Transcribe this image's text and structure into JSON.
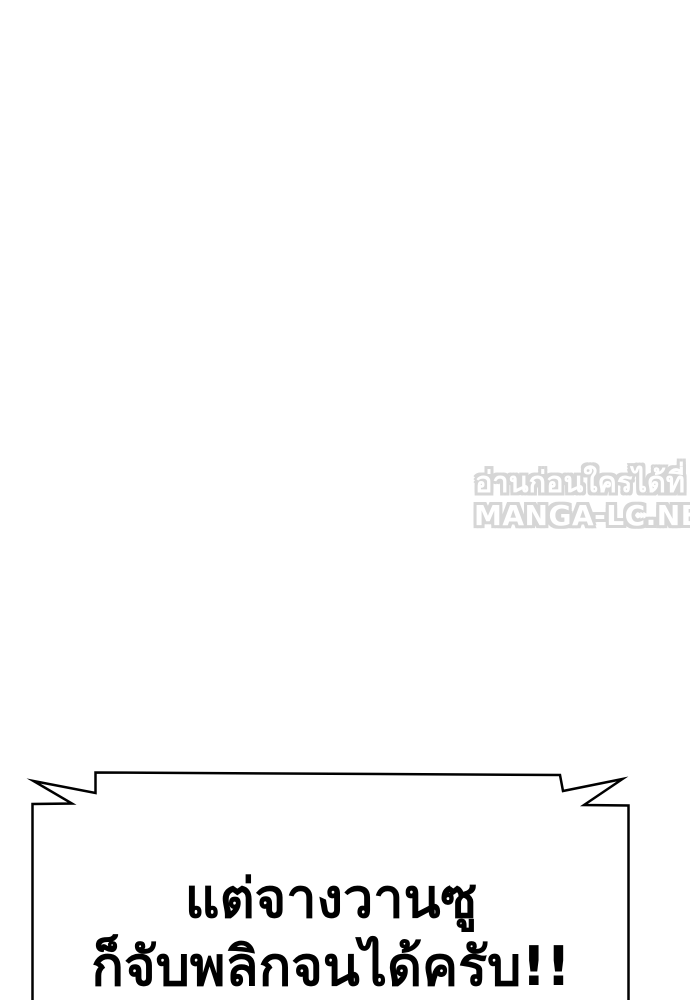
{
  "page": {
    "background_color": "#ffffff"
  },
  "watermark": {
    "line1": "อ่านก่อนใครได้ที่",
    "line2": "MANGA-LC.NET",
    "fill_color": "#ffffff",
    "outline_color": "#d6d6d6"
  },
  "speech_bubble": {
    "text_line1": "แต่จางวานซู",
    "text_line2": "ก็จับพลิกจนได้ครับ!!",
    "fill_color": "#ffffff",
    "border_color": "#000000",
    "text_color": "#000000"
  }
}
